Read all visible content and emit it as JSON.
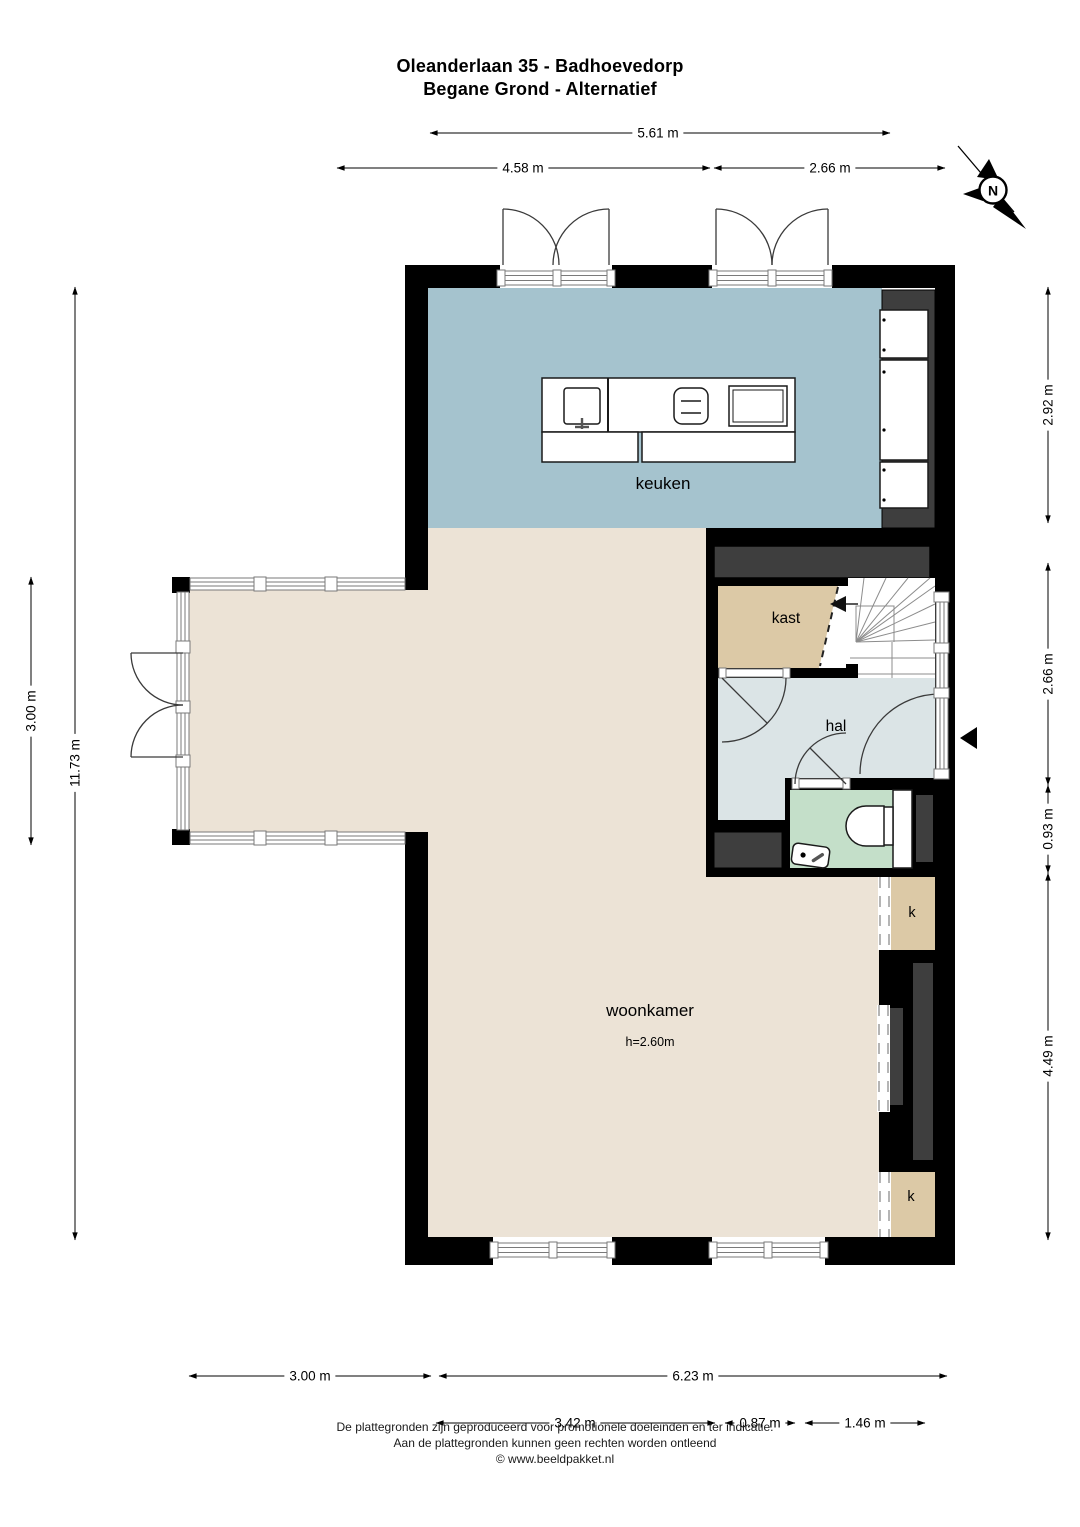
{
  "title": {
    "line1": "Oleanderlaan 35 - Badhoevedorp",
    "line2": "Begane Grond - Alternatief"
  },
  "compass": {
    "north_label": "N"
  },
  "rooms": {
    "keuken": "keuken",
    "kast": "kast",
    "hal": "hal",
    "woonkamer": "woonkamer",
    "woonkamer_height": "h=2.60m",
    "closet_top": "k",
    "closet_bottom": "k"
  },
  "dimensions": {
    "top": {
      "total": "5.61 m",
      "left": "4.58 m",
      "right": "2.66 m"
    },
    "right": {
      "keuken": "2.92 m",
      "hal": "2.66 m",
      "toilet": "0.93 m",
      "woonkamer": "4.49 m"
    },
    "left": {
      "total": "11.73 m",
      "bay": "3.00 m"
    },
    "bottom": {
      "bay": "3.00 m",
      "main": "6.23 m",
      "sub1": "3.42 m",
      "sub2": "0.87 m",
      "sub3": "1.46 m"
    }
  },
  "footer": {
    "line1": "De plattegronden zijn geproduceerd voor promotionele doeleinden en ter indicatie.",
    "line2": "Aan de plattegronden kunnen geen rechten worden ontleend",
    "line3": "© www.beeldpakket.nl"
  },
  "colors": {
    "wall": "#000000",
    "inner_wall": "#3e3e3e",
    "keuken_floor": "#a5c3ce",
    "woonkamer_floor": "#ece3d6",
    "kast_floor": "#dcc9a6",
    "hal_floor": "#dbe4e6",
    "toilet_floor": "#c4dfc9"
  }
}
